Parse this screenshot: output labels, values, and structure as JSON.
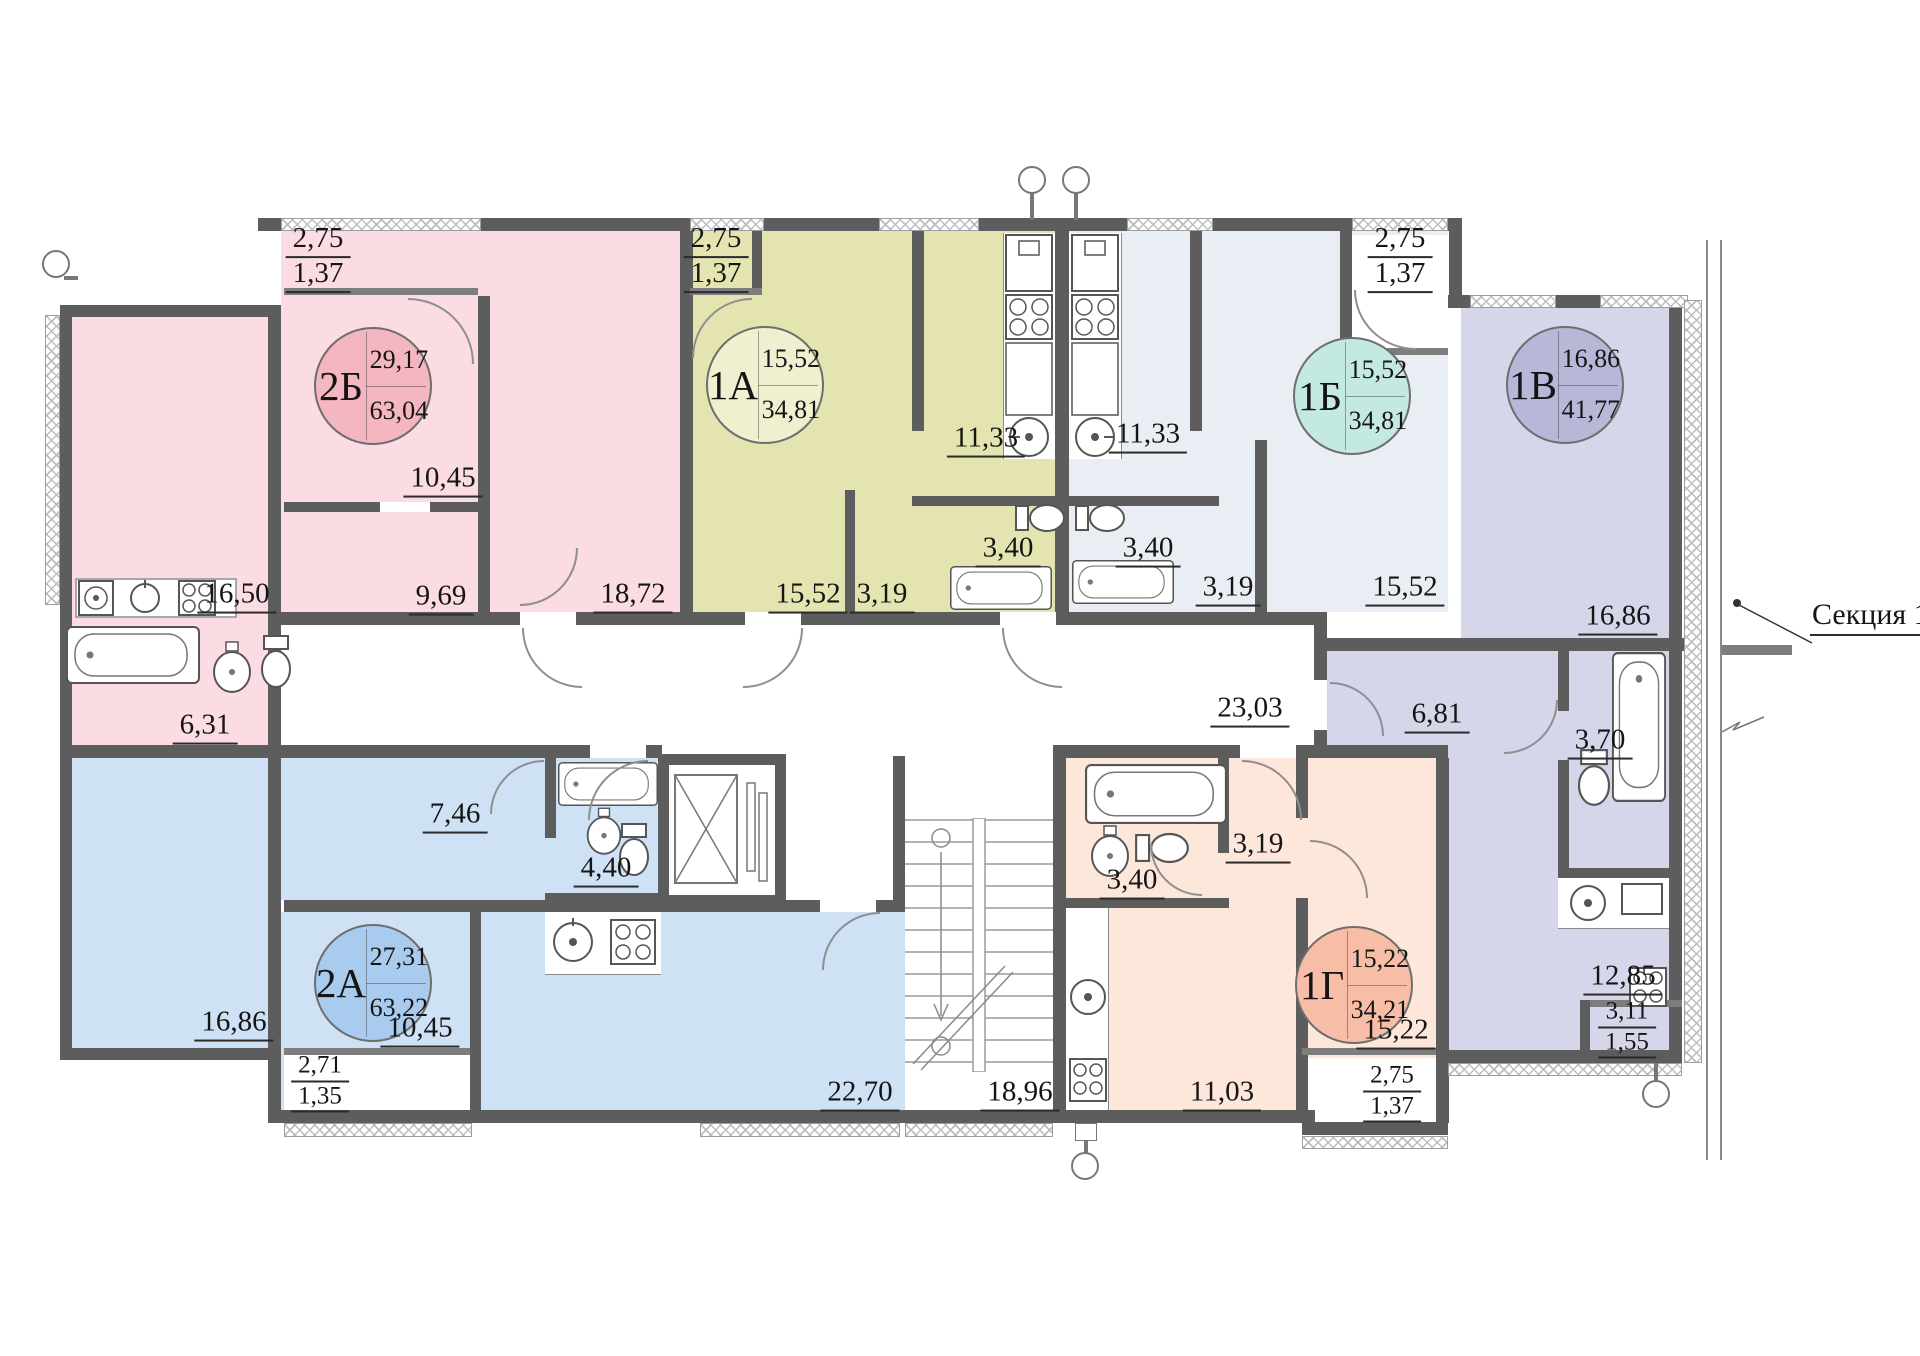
{
  "floor_plan": {
    "section_label": "Секция 17",
    "wall_color": "#5d5d5d",
    "apartments": [
      {
        "id": "2B",
        "code": "2Б",
        "living_area": "29,17",
        "total_area": "63,04",
        "fill": "#fbdce2",
        "badge_color": "#f4b6c0",
        "rooms": {
          "balcony_a": "2,75",
          "balcony_b": "1,37",
          "bedroom": "10,45",
          "kitchen": "16,50",
          "hall": "9,69",
          "living_room": "18,72",
          "bathroom": "6,31"
        }
      },
      {
        "id": "1A",
        "code": "1А",
        "living_area": "15,52",
        "total_area": "34,81",
        "fill": "#e4e4b0",
        "badge_color": "#eef0cf",
        "rooms": {
          "balcony_a": "2,75",
          "balcony_b": "1,37",
          "room": "15,52",
          "hall": "3,19",
          "kitchen": "11,33",
          "bathroom": "3,40"
        }
      },
      {
        "id": "1B",
        "code": "1Б",
        "living_area": "15,52",
        "total_area": "34,81",
        "fill": "#e9eef4",
        "badge_color": "#c3e9e1",
        "rooms": {
          "balcony_a": "2,75",
          "balcony_b": "1,37",
          "room": "15,52",
          "hall": "3,19",
          "kitchen": "11,33",
          "bathroom": "3,40"
        }
      },
      {
        "id": "1V",
        "code": "1В",
        "living_area": "16,86",
        "total_area": "41,77",
        "fill": "#d5d6e9",
        "badge_color": "#b7b8d8",
        "rooms": {
          "room": "16,86",
          "hall": "6,81",
          "bathroom": "3,70",
          "kitchen": "12,85",
          "balcony_a": "3,11",
          "balcony_b": "1,55"
        }
      },
      {
        "id": "2A",
        "code": "2А",
        "living_area": "27,31",
        "total_area": "63,22",
        "fill": "#cfe2f5",
        "badge_color": "#a9cbee",
        "rooms": {
          "bedroom_1": "16,86",
          "bedroom_2": "10,45",
          "hall": "7,46",
          "bathroom": "4,40",
          "living_room": "22,70",
          "balcony_a": "2,71",
          "balcony_b": "1,35"
        }
      },
      {
        "id": "1G",
        "code": "1Г",
        "living_area": "15,22",
        "total_area": "34,21",
        "fill": "#fde6da",
        "badge_color": "#f7bda6",
        "rooms": {
          "bathroom": "3,40",
          "hall": "3,19",
          "kitchen": "11,03",
          "room": "15,22",
          "balcony_a": "2,75",
          "balcony_b": "1,37"
        }
      }
    ],
    "common_areas": {
      "corridor": "23,03",
      "stairwell": "18,96"
    }
  }
}
